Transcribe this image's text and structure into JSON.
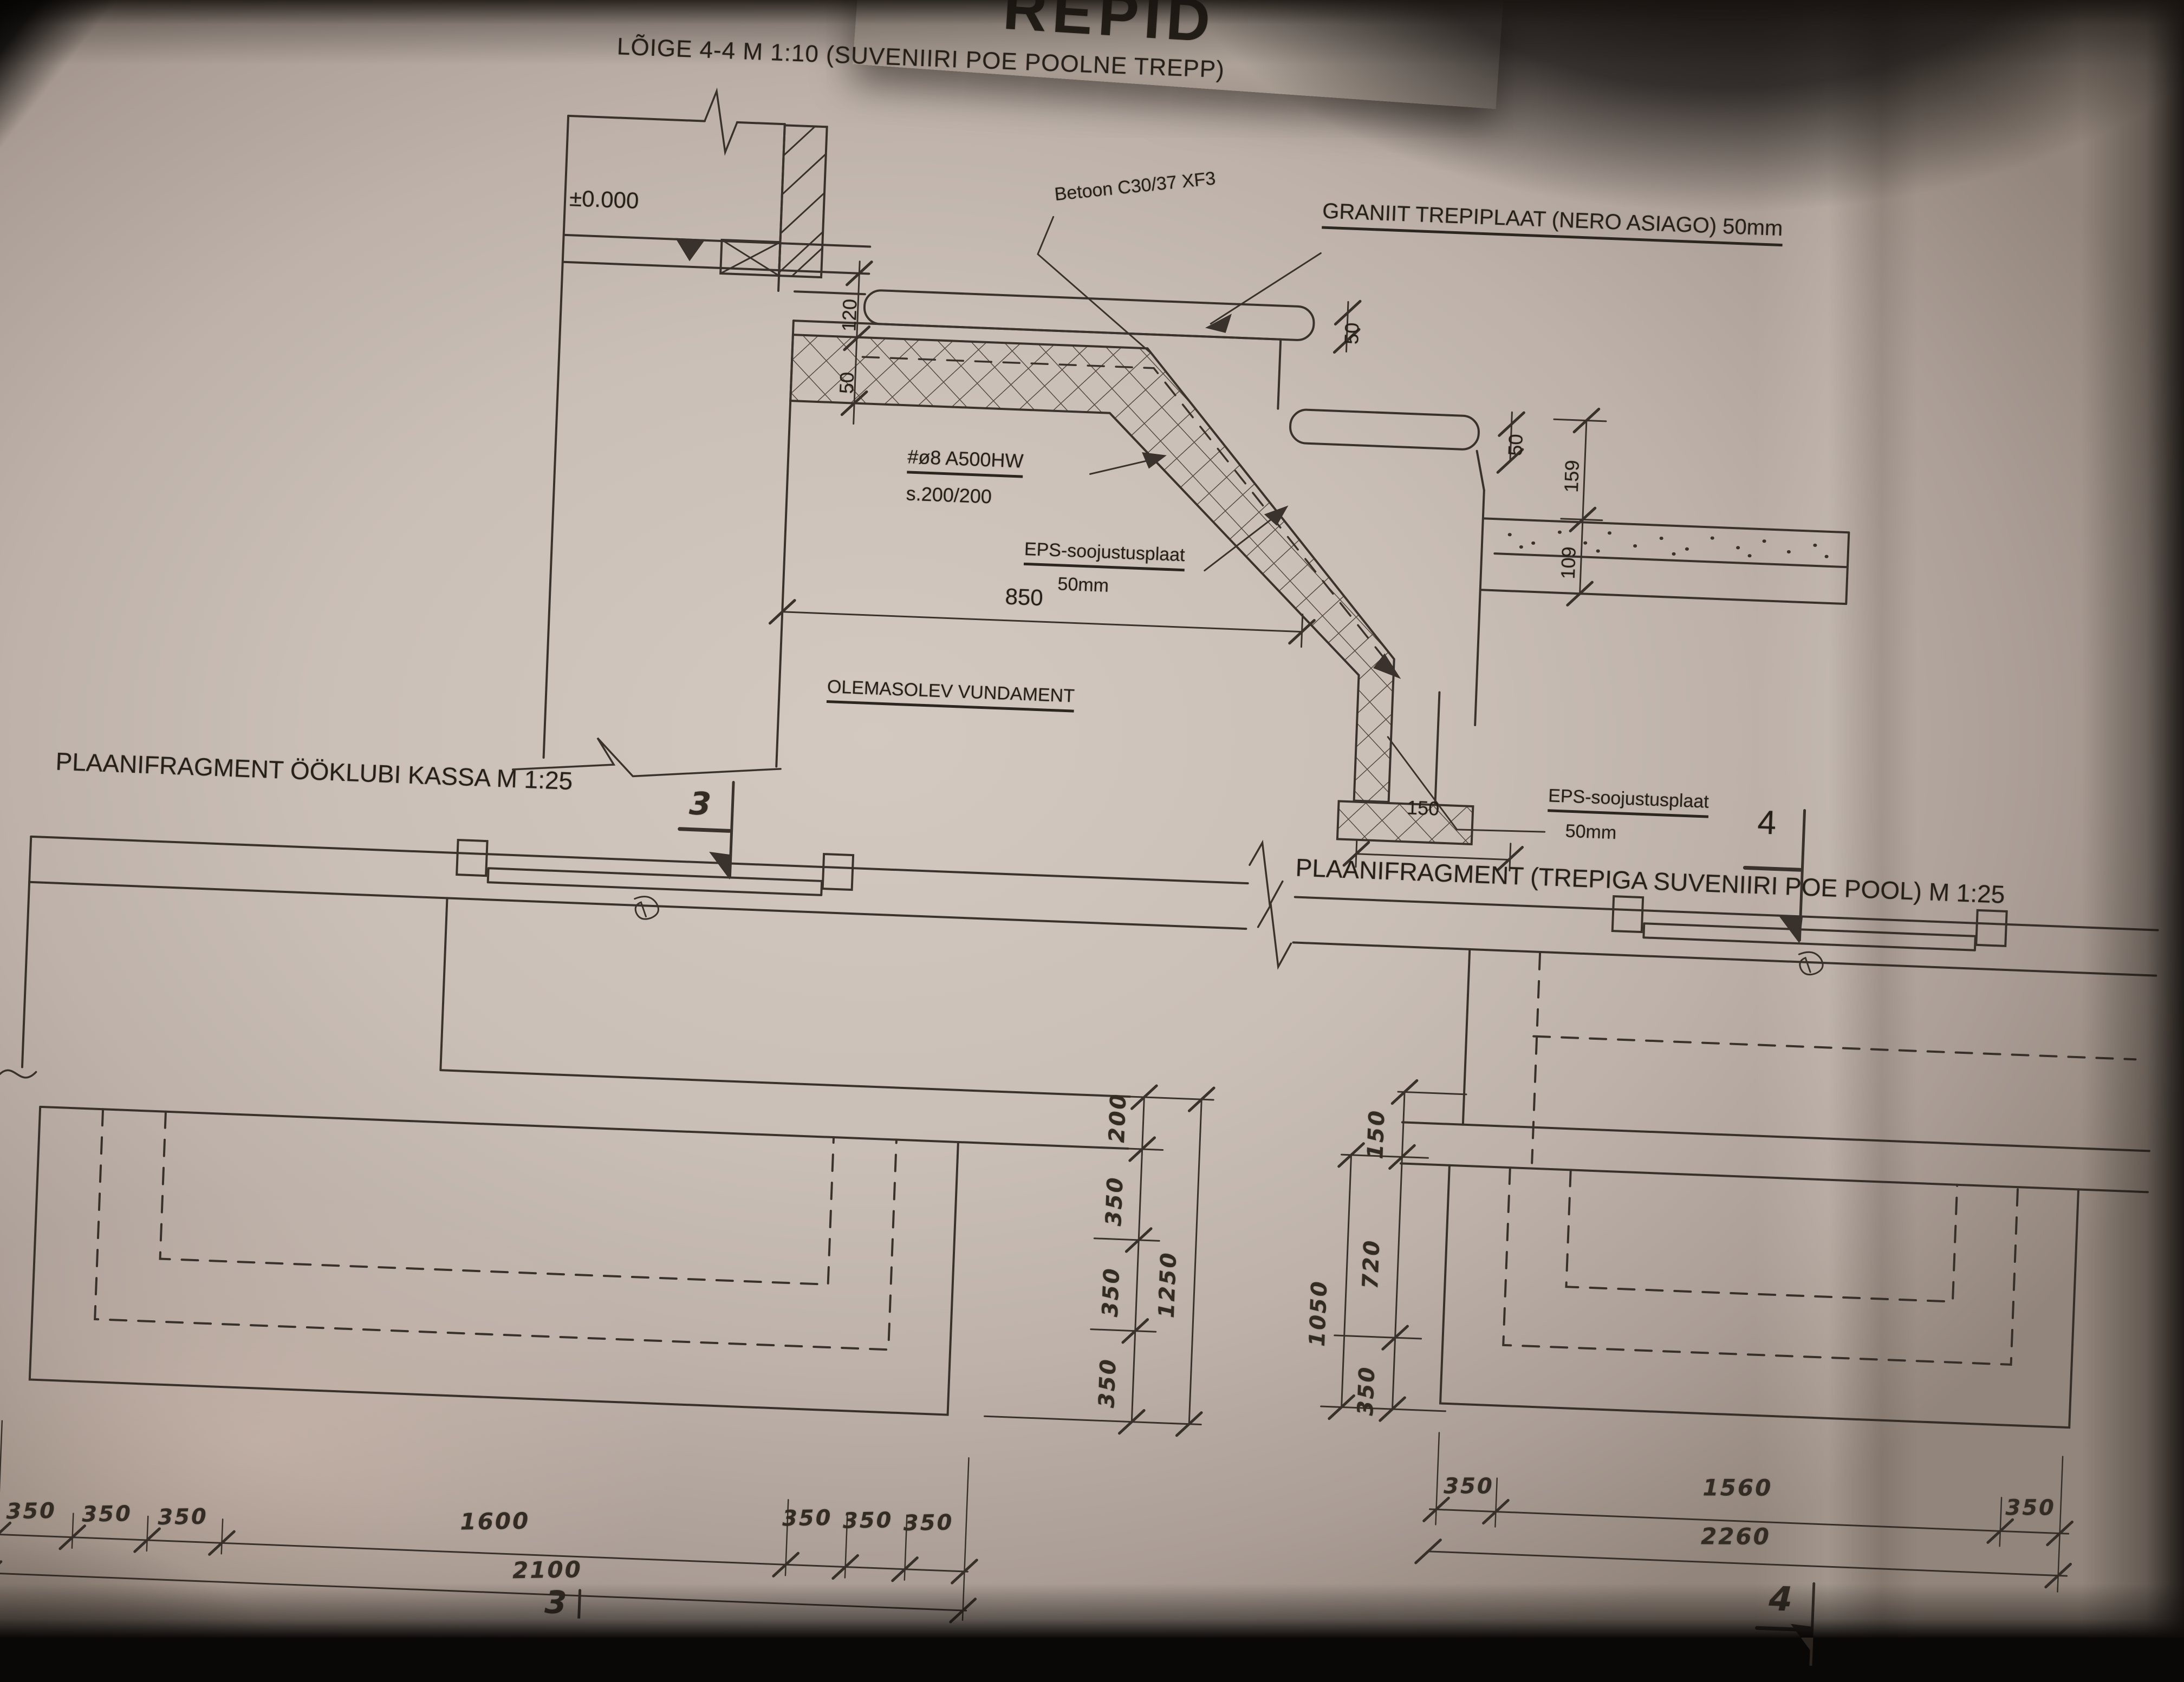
{
  "photo": {
    "top_sheet_fragment": "REPID"
  },
  "section": {
    "title": "LÕIGE 4-4   M  1:10 (SUVENIIRI POE POOLNE TREPP)",
    "level_label": "±0.000",
    "concrete_label": "Betoon  C30/37  XF3",
    "granite_label": "GRANIIT TREPIPLAAT  (NERO ASIAGO)  50mm",
    "rebar_line1": "#ø8  A500HW",
    "rebar_line2": "s.200/200",
    "eps_label_1_line1": "EPS-soojustusplaat",
    "eps_label_1_line2": "50mm",
    "foundation_label": "OLEMASOLEV VUNDAMENT",
    "eps_label_2_line1": "EPS-soojustusplaat",
    "eps_label_2_line2": "50mm",
    "section_marker": "4",
    "dims": {
      "d850": "850",
      "d150": "150",
      "d120": "120",
      "d50_left": "50",
      "d50_tread1": "50",
      "d50_tread2": "50",
      "d159": "159",
      "d109": "109"
    }
  },
  "plan_left": {
    "title": "PLAANIFRAGMENT ÖÖKLUBI KASSA M 1:25",
    "section_marker_top": "3",
    "section_marker_bottom": "3",
    "vertical_dims": [
      "200",
      "350",
      "350",
      "350"
    ],
    "vertical_total": "1250",
    "bottom_dims_row1": [
      "350",
      "350",
      "350"
    ],
    "bottom_dim_1600": "1600",
    "bottom_dims_row1_right": [
      "350",
      "350",
      "350"
    ],
    "bottom_total": "2100"
  },
  "plan_right": {
    "title": "PLAANIFRAGMENT (TREPIGA SUVENIIRI POE POOL)  M 1:25",
    "section_marker_bottom": "4",
    "vertical_dims": [
      "150",
      "720",
      "350"
    ],
    "vertical_total": "1050",
    "bottom_dims": [
      "350",
      "1560",
      "350"
    ],
    "bottom_total": "2260"
  }
}
